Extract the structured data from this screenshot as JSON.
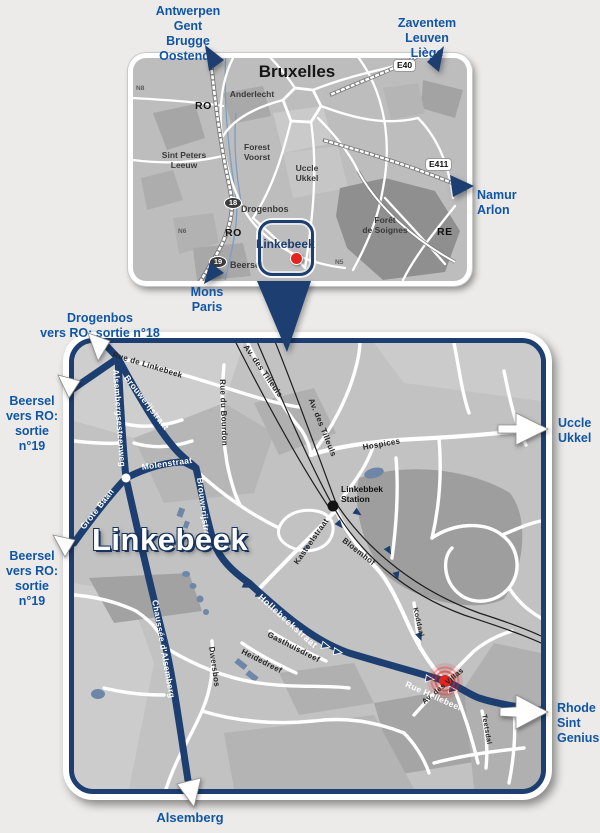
{
  "colors": {
    "navy": "#1c3e70",
    "label_blue": "#1156a5",
    "road_white": "#ffffff",
    "map_gray": "#c2c2c2",
    "forest_gray": "#9e9e9e",
    "water_blue": "#6e87a9",
    "marker_red": "#e3231d"
  },
  "inset": {
    "title": "Bruxelles",
    "anderlecht": "Anderlecht",
    "sint_peters_leeuw": "Sint Peters\nLeeuw",
    "forest_voorst": "Forest\nVoorst",
    "uccle_ukkel": "Uccle\nUkkel",
    "foret_de_soignes": "Forêt\nde Soignes",
    "drogenbos": "Drogenbos",
    "beersel": "Beersel",
    "ro_top": "RO",
    "ro_bottom": "RO",
    "re": "RE",
    "n8": "N8",
    "n6": "N6",
    "n5": "N5",
    "e40": "E40",
    "e411": "E411",
    "exit18": "18",
    "exit19": "19",
    "highlight": "Linkebeek"
  },
  "edges": {
    "antwerpen": "Antwerpen\nGent\nBrugge\nOostende",
    "zaventem": "Zaventem\nLeuven\nLiège",
    "namur": "Namur\nArlon",
    "mons": "Mons\nParis",
    "drogenbos_exit": "Drogenbos\nvers RO: sortie n°18",
    "beersel_exit_top": "Beersel\nvers RO:\nsortie n°19",
    "beersel_exit_bottom": "Beersel\nvers RO:\nsortie n°19",
    "uccle": "Uccle\nUkkel",
    "rhode": "Rhode\nSint\nGenius",
    "alsemberg": "Alsemberg"
  },
  "detail": {
    "town": "Linkebeek",
    "station": "Linkebbek\nStation",
    "streets": {
      "rue_de_linkebeek": "Rue de Linkebeek",
      "alsembergsesteenweg": "Alsembergsesteenweg",
      "brouwerijstraat": "Brouwerijstraat",
      "molenstraat": "Molenstraat",
      "grote_baan": "Grote Baan",
      "av_des_tilleuls": "Av. des Tilleuls",
      "rue_du_bourdon": "Rue du Bourdon",
      "hospices": "Hospices",
      "kasteelstraat": "Kasteelstraat",
      "bloemhof": "Bloemhof",
      "chaussee_alsemberg": "Chaussée d'Alsemberg",
      "dwersbos": "Dwersbos",
      "heidedreef": "Heidedreef",
      "gasthuisdreef": "Gasthuisdreef",
      "hollebeekstraat": "Hollebeekstraat",
      "rue_hollebeek": "Rue  Hollebeek",
      "av_des_villas": "Av. des Villas",
      "koddaal": "Koddaal",
      "teetsdal": "Teetsdal"
    }
  }
}
